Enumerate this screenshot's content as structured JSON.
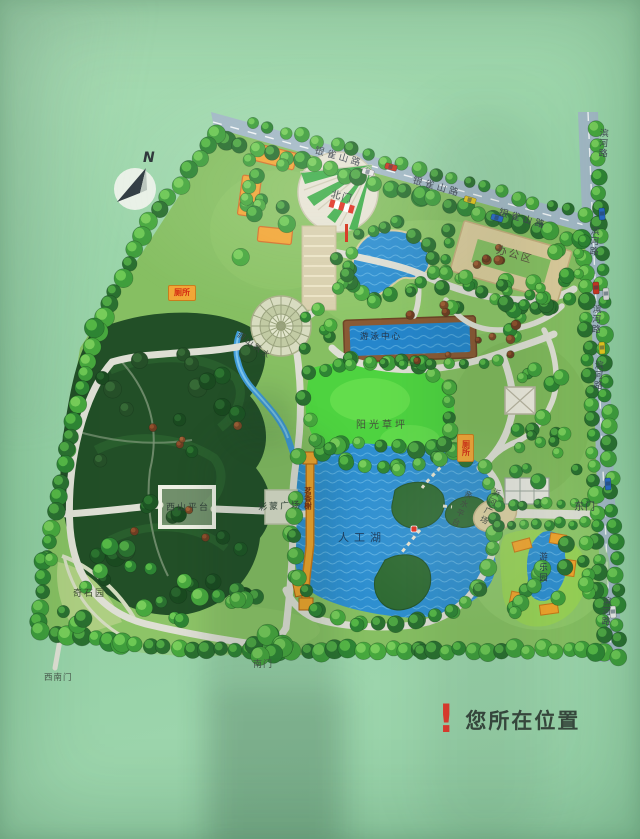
{
  "compass": {
    "north_label": "N"
  },
  "legend": {
    "marker": "!",
    "label": "您所在位置"
  },
  "roads": {
    "yinqueshan": {
      "labels": [
        "银雀山路",
        "银雀山路",
        "银雀山路"
      ]
    },
    "binhe": {
      "labels": [
        "滨河路",
        "滨河路",
        "滨河路",
        "滨河路",
        "滨河路"
      ]
    }
  },
  "gates": {
    "north": "北门",
    "east": "东门",
    "south": "南门",
    "southwest": "西南门"
  },
  "places": {
    "office_area": "办公区",
    "swimming_center": "游泳中心",
    "sunshine_lawn": "阳光草坪",
    "artificial_lake": "人工湖",
    "rockery_falls": "假山跌水",
    "west_hill_platform": "西山平台",
    "caimeng_square": "彩蒙广场",
    "strange_stone_garden": "奇石园",
    "waterside_platform": "亲水平台",
    "yihe_square": "沂河广场",
    "fragrance_pavilion": "茗香榭",
    "amusement_garden": "游乐园"
  },
  "facilities": {
    "toilet_north": "厕所",
    "toilet_east": "厕所"
  },
  "colors": {
    "board_green": "#96d1a8",
    "road_gray": "#a3b9c6",
    "water_blue": "#2e8fd0",
    "lawn_green": "#4fd03e",
    "path_gray": "#dedfd4",
    "structure_orange": "#f2a636",
    "alert_red": "#e23b2e",
    "forest_dark": "#224f27"
  }
}
